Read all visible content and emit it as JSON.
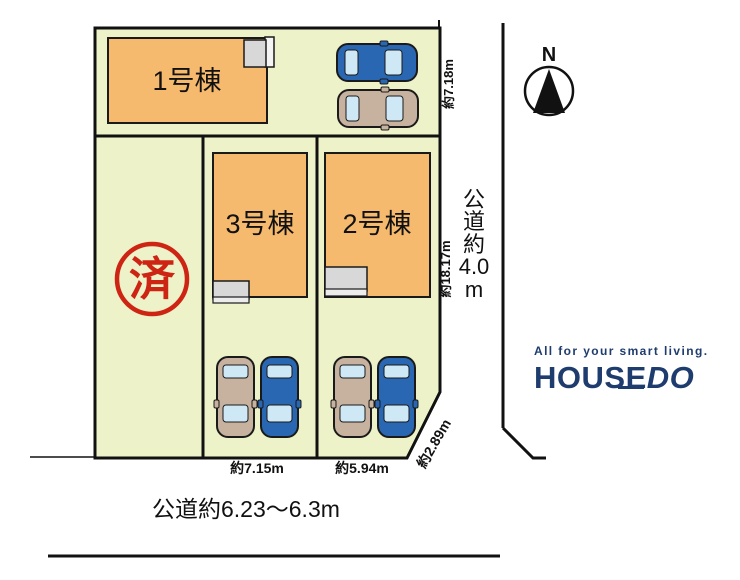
{
  "site_plan": {
    "buildings": [
      {
        "label": "1号棟"
      },
      {
        "label": "2号棟"
      },
      {
        "label": "3号棟"
      }
    ],
    "sold_stamp": "済",
    "dimensions": {
      "top_right_edge": "約7.18m",
      "right_edge": "約18.17m",
      "corner_diagonal": "約2.89m",
      "bottom_center_parcel": "約7.15m",
      "bottom_right_parcel": "約5.94m"
    },
    "roads": {
      "bottom_label": "公道約6.23〜6.3m",
      "right_label_chars": [
        "公",
        "道",
        "約",
        "4.0",
        "m"
      ]
    },
    "compass_label": "N"
  },
  "branding": {
    "tagline": "All for your smart living.",
    "brand_house": "HOUSE",
    "brand_do": "DO"
  },
  "colors": {
    "plot_fill": "#edf2c9",
    "building_fill": "#f6ba6e",
    "porch_gray": "#d8d8d8",
    "stamp_red": "#cd2413",
    "car_blue": "#2a67b2",
    "car_beige": "#c7b19f",
    "car_window": "#cfe8f5",
    "logo_navy": "#1e3c6d",
    "line_black": "#111111"
  }
}
